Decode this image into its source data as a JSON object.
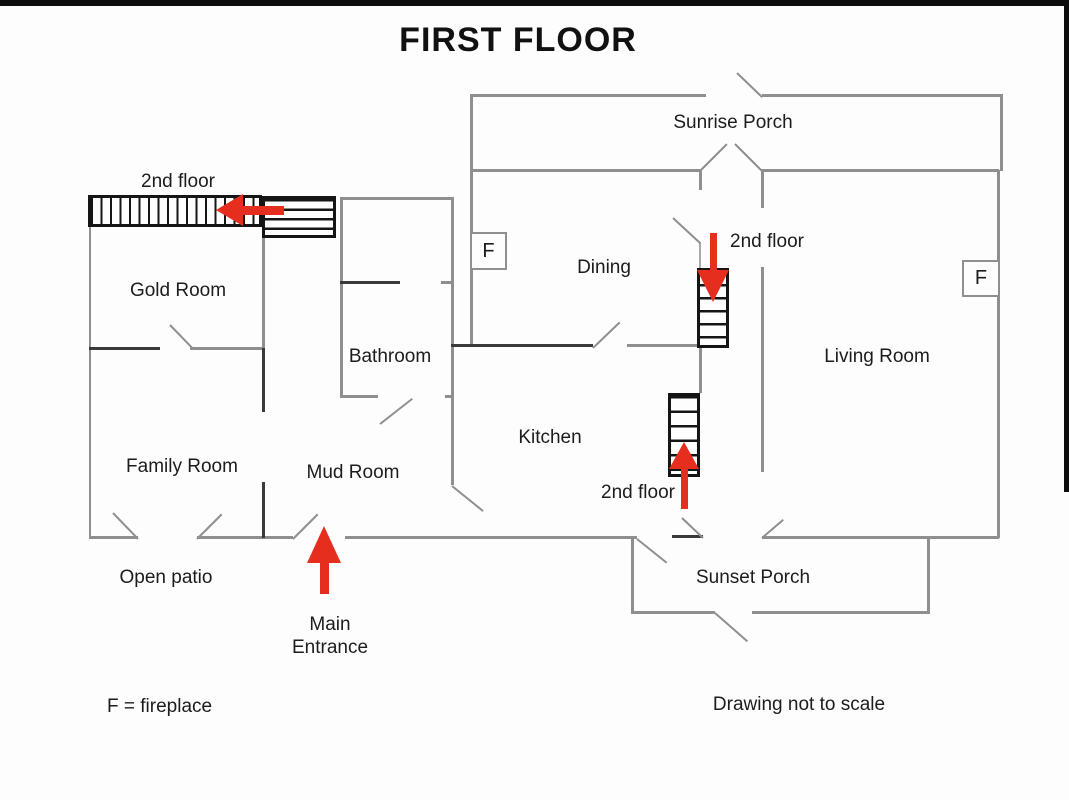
{
  "title": "FIRST FLOOR",
  "labels": {
    "sunrise_porch": "Sunrise Porch",
    "sunset_porch": "Sunset Porch",
    "gold_room": "Gold Room",
    "dining": "Dining",
    "living_room": "Living Room",
    "bathroom": "Bathroom",
    "kitchen": "Kitchen",
    "family_room": "Family Room",
    "mud_room": "Mud Room",
    "open_patio": "Open patio",
    "second_floor_upper_left": "2nd floor",
    "second_floor_dining": "2nd floor",
    "second_floor_kitchen": "2nd floor",
    "main_entrance_line1": "Main",
    "main_entrance_line2": "Entrance",
    "fireplace_legend": "F = fireplace",
    "not_to_scale_note": "Drawing not to scale",
    "fireplace_symbol_left": "F",
    "fireplace_symbol_right": "F"
  },
  "arrows": [
    {
      "name": "stairs-arrow-upper-left",
      "direction": "left"
    },
    {
      "name": "stairs-arrow-dining",
      "direction": "down"
    },
    {
      "name": "stairs-arrow-kitchen",
      "direction": "up"
    },
    {
      "name": "main-entrance-arrow",
      "direction": "up"
    }
  ],
  "colors": {
    "wall_gray": "#8f8f8f",
    "wall_dark": "#3a3a3a",
    "stairs_black": "#151515",
    "arrow_red": "#e62e1f",
    "text": "#1c1c1c",
    "background": "#fdfdfd"
  }
}
